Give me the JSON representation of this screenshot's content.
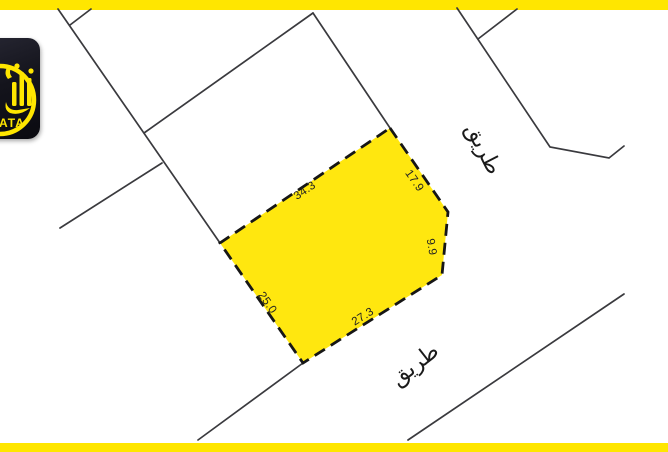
{
  "logo": {
    "visible_text": "ATA"
  },
  "map": {
    "plot": {
      "measurements": {
        "nw": "34.3",
        "ne": "17.9",
        "e": "9.9",
        "se": "27.3",
        "sw": "25.0"
      }
    },
    "roads": {
      "top_label": "طريق",
      "bottom_label": "طريق"
    }
  },
  "colors": {
    "accent_yellow": "#ffe600",
    "plot_fill": "#ffe70f",
    "boundary_line": "#3a3a3e",
    "plot_dash": "#161616",
    "logo_background": "#14141c",
    "logo_accent": "#ffe600",
    "label_text": "#222222"
  }
}
